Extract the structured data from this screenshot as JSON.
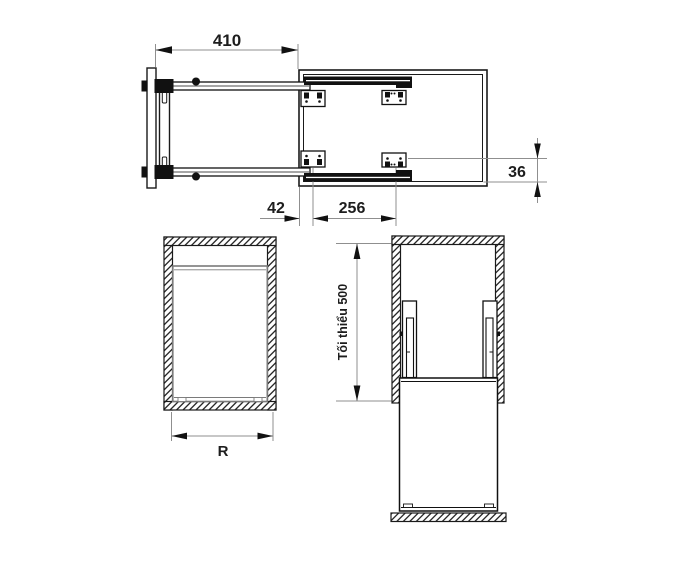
{
  "drawing": {
    "type": "technical-installation-drawing",
    "views": {
      "plan": "top view of pull-out frame extended from cabinet",
      "front": "front section of cabinet with unit",
      "side": "side section of cabinet with slides and minimum height"
    }
  },
  "dimensions": {
    "pull_out_length": "410",
    "front_gap": "42",
    "bracket_spacing": "256",
    "rail_offset": "36",
    "internal_width": "R",
    "min_install_height": "Tối thiểu 500"
  },
  "colors": {
    "background": "#ffffff",
    "drawing_line": "#1a1a1a",
    "dimension_line": "#8f8f8f",
    "unit_line": "#7a7a7a",
    "text": "#1d1d1d"
  }
}
